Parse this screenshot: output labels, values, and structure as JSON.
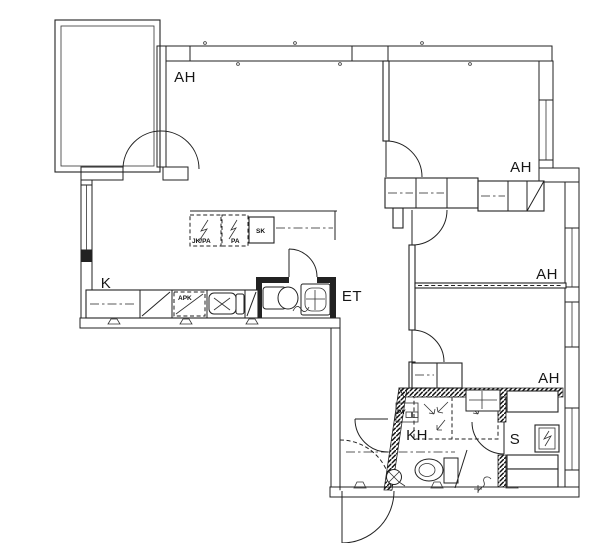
{
  "drawing_type": "apartment floor plan",
  "rooms": {
    "living": {
      "label": "AH"
    },
    "bedroom_top": {
      "label": "AH"
    },
    "bedroom_mid": {
      "label": "AH"
    },
    "bedroom_low": {
      "label": "AH"
    },
    "kitchen": {
      "label": "K"
    },
    "entrance_hall": {
      "label": "ET"
    },
    "bathroom": {
      "label": "KH"
    },
    "sauna": {
      "label": "S"
    }
  },
  "appliances": {
    "fridge_freezer": "JK/PA",
    "freezer": "PA",
    "cleaning_closet": "SK",
    "dishwasher": "APK",
    "laundry_machine": "PY"
  },
  "colors": {
    "ink": "#222222",
    "paper": "#ffffff"
  }
}
